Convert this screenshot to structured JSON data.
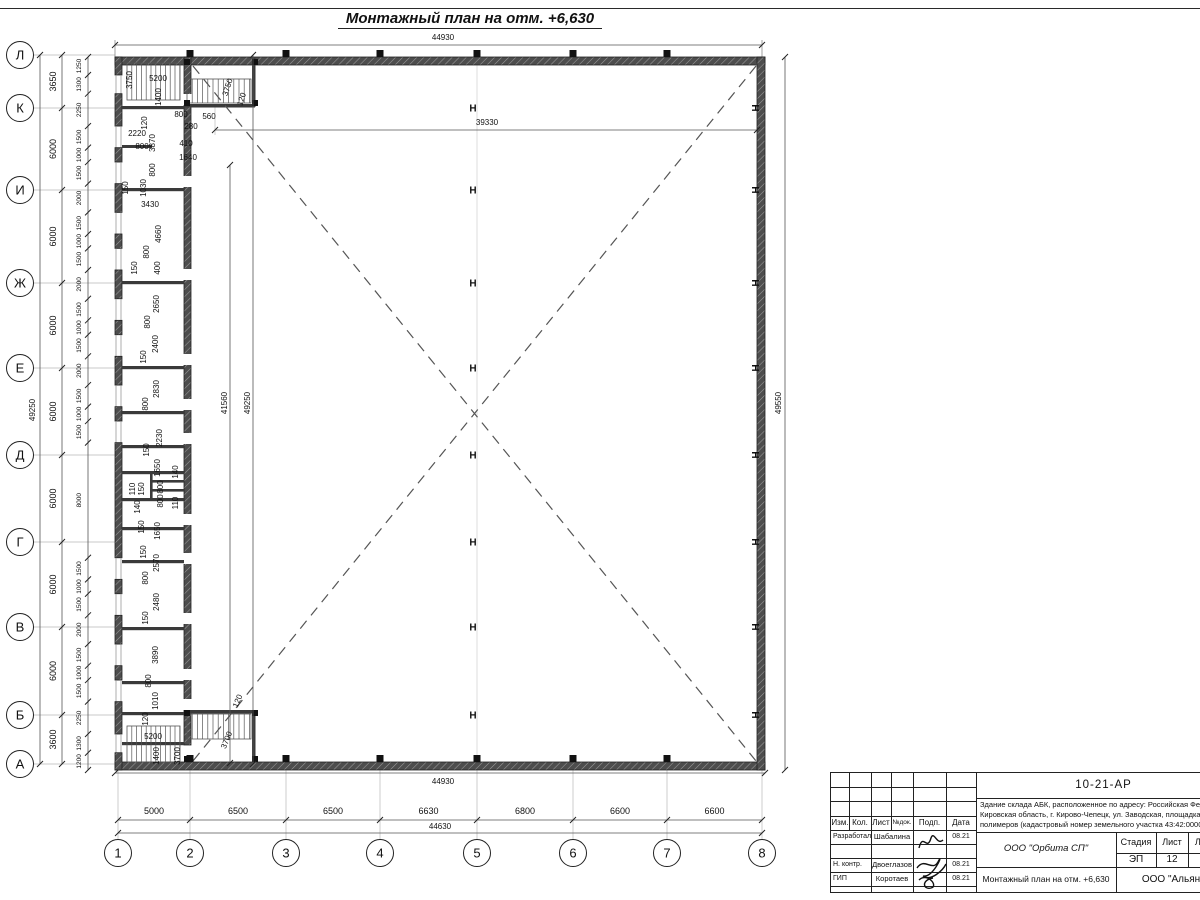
{
  "title": "Монтажный план на отм. +6,630",
  "axes_left": {
    "labels": [
      "Л",
      "К",
      "И",
      "Ж",
      "Е",
      "Д",
      "Г",
      "В",
      "Б",
      "А"
    ],
    "y": [
      55,
      108,
      190,
      283,
      368,
      455,
      542,
      627,
      715,
      764
    ],
    "dims": [
      "3650",
      "6000",
      "6000",
      "6000",
      "6000",
      "6000",
      "6000",
      "6000",
      "3600"
    ],
    "overall": "49250",
    "fine_dims": [
      "1250",
      "1300",
      "2250",
      "1500",
      "1000",
      "1500",
      "2000",
      "1500",
      "1000",
      "1500",
      "2000",
      "1500",
      "1000",
      "1500",
      "2000",
      "1500",
      "1000",
      "1500",
      "8000",
      "1500",
      "1000",
      "1500",
      "2000",
      "1500",
      "1000",
      "1500",
      "2250",
      "1300",
      "1200"
    ]
  },
  "axes_bottom": {
    "labels": [
      "1",
      "2",
      "3",
      "4",
      "5",
      "6",
      "7",
      "8"
    ],
    "x": [
      118,
      190,
      286,
      380,
      477,
      573,
      667,
      762
    ],
    "dims": [
      "5000",
      "6500",
      "6500",
      "6630",
      "6800",
      "6600",
      "6600"
    ],
    "overall": "44630"
  },
  "plan": {
    "column_symbol": "Н"
  },
  "annotations": [
    {
      "t": "44930",
      "x": 443,
      "y": 40,
      "r": 0
    },
    {
      "t": "44930",
      "x": 443,
      "y": 784,
      "r": 0
    },
    {
      "t": "39330",
      "x": 487,
      "y": 125,
      "r": 0
    },
    {
      "t": "41560",
      "x": 227,
      "y": 403,
      "r": -90
    },
    {
      "t": "49250",
      "x": 250,
      "y": 403,
      "r": -90
    },
    {
      "t": "49550",
      "x": 781,
      "y": 403,
      "r": -90
    },
    {
      "t": "49250",
      "x": 35,
      "y": 410,
      "r": -90
    },
    {
      "t": "44630",
      "x": 440,
      "y": 829,
      "r": 0
    },
    {
      "t": "3750",
      "x": 132,
      "y": 80,
      "r": -90
    },
    {
      "t": "5200",
      "x": 158,
      "y": 81,
      "r": 0
    },
    {
      "t": "1400",
      "x": 161,
      "y": 97,
      "r": -90
    },
    {
      "t": "120",
      "x": 147,
      "y": 123,
      "r": -90
    },
    {
      "t": "2220",
      "x": 137,
      "y": 136,
      "r": 0
    },
    {
      "t": "800",
      "x": 142,
      "y": 149,
      "r": 0
    },
    {
      "t": "3870",
      "x": 155,
      "y": 143,
      "r": -90
    },
    {
      "t": "800",
      "x": 155,
      "y": 170,
      "r": -90
    },
    {
      "t": "280",
      "x": 191,
      "y": 129,
      "r": 0
    },
    {
      "t": "410",
      "x": 186,
      "y": 146,
      "r": 0
    },
    {
      "t": "1640",
      "x": 188,
      "y": 160,
      "r": 0
    },
    {
      "t": "800",
      "x": 181,
      "y": 117,
      "r": 0
    },
    {
      "t": "560",
      "x": 209,
      "y": 119,
      "r": 0
    },
    {
      "t": "3750",
      "x": 230,
      "y": 88,
      "r": -72
    },
    {
      "t": "120",
      "x": 244,
      "y": 100,
      "r": -72
    },
    {
      "t": "150",
      "x": 128,
      "y": 188,
      "r": -90
    },
    {
      "t": "1030",
      "x": 146,
      "y": 188,
      "r": -90
    },
    {
      "t": "3430",
      "x": 150,
      "y": 207,
      "r": 0
    },
    {
      "t": "4660",
      "x": 161,
      "y": 234,
      "r": -90
    },
    {
      "t": "800",
      "x": 149,
      "y": 252,
      "r": -90
    },
    {
      "t": "150",
      "x": 137,
      "y": 268,
      "r": -90
    },
    {
      "t": "400",
      "x": 160,
      "y": 268,
      "r": -90
    },
    {
      "t": "2650",
      "x": 159,
      "y": 304,
      "r": -90
    },
    {
      "t": "800",
      "x": 150,
      "y": 322,
      "r": -90
    },
    {
      "t": "2400",
      "x": 158,
      "y": 344,
      "r": -90
    },
    {
      "t": "150",
      "x": 146,
      "y": 357,
      "r": -90
    },
    {
      "t": "2830",
      "x": 159,
      "y": 389,
      "r": -90
    },
    {
      "t": "800",
      "x": 148,
      "y": 404,
      "r": -90
    },
    {
      "t": "2230",
      "x": 162,
      "y": 438,
      "r": -90
    },
    {
      "t": "150",
      "x": 149,
      "y": 450,
      "r": -90
    },
    {
      "t": "1650",
      "x": 160,
      "y": 468,
      "r": -90
    },
    {
      "t": "140",
      "x": 178,
      "y": 472,
      "r": -90
    },
    {
      "t": "110",
      "x": 135,
      "y": 489,
      "r": -90
    },
    {
      "t": "150",
      "x": 144,
      "y": 489,
      "r": -90
    },
    {
      "t": "800",
      "x": 163,
      "y": 487,
      "r": -90
    },
    {
      "t": "800",
      "x": 163,
      "y": 501,
      "r": -90
    },
    {
      "t": "140",
      "x": 140,
      "y": 507,
      "r": -90
    },
    {
      "t": "110",
      "x": 178,
      "y": 503,
      "r": -90
    },
    {
      "t": "150",
      "x": 144,
      "y": 527,
      "r": -90
    },
    {
      "t": "1650",
      "x": 160,
      "y": 531,
      "r": -90
    },
    {
      "t": "150",
      "x": 146,
      "y": 552,
      "r": -90
    },
    {
      "t": "2570",
      "x": 159,
      "y": 563,
      "r": -90
    },
    {
      "t": "800",
      "x": 148,
      "y": 578,
      "r": -90
    },
    {
      "t": "2480",
      "x": 159,
      "y": 602,
      "r": -90
    },
    {
      "t": "150",
      "x": 148,
      "y": 618,
      "r": -90
    },
    {
      "t": "3890",
      "x": 158,
      "y": 655,
      "r": -90
    },
    {
      "t": "800",
      "x": 151,
      "y": 681,
      "r": -90
    },
    {
      "t": "1010",
      "x": 158,
      "y": 701,
      "r": -90
    },
    {
      "t": "120",
      "x": 148,
      "y": 719,
      "r": -90
    },
    {
      "t": "5200",
      "x": 153,
      "y": 739,
      "r": 0
    },
    {
      "t": "1400",
      "x": 159,
      "y": 756,
      "r": -90
    },
    {
      "t": "3700",
      "x": 180,
      "y": 756,
      "r": -90
    },
    {
      "t": "120",
      "x": 240,
      "y": 702,
      "r": -68
    },
    {
      "t": "3700",
      "x": 229,
      "y": 741,
      "r": -68
    }
  ],
  "titleblock": {
    "doc_number": "10-21-АР",
    "description_lines": [
      "Здание склада АБК, расположенное по адресу: Российская Феде",
      "Кировская область, г. Кирово-Чепецк, ул. Заводская, площадка з",
      "полимеров (кадастровый номер земельного участка 43:42:0000"
    ],
    "header_cols": [
      "Изм.",
      "Кол.",
      "Лист",
      "№док.",
      "Подп.",
      "Дата"
    ],
    "rows": [
      {
        "role": "Разработал",
        "name": "Шабалина",
        "date": "08.21"
      },
      {
        "role": "Н. контр.",
        "name": "Двоеглазов",
        "date": "08.21"
      },
      {
        "role": "ГИП",
        "name": "Коротаев",
        "date": "08.21"
      }
    ],
    "org": "ООО \"Орбита СП\"",
    "stage_label": "Стадия",
    "sheet_label": "Лист",
    "sheets_label": "Листов",
    "stage": "ЭП",
    "sheet": "12",
    "sheets": "1",
    "subtitle": "Монтажный план на отм. +6,630",
    "org2": "ООО \"Альянс"
  }
}
